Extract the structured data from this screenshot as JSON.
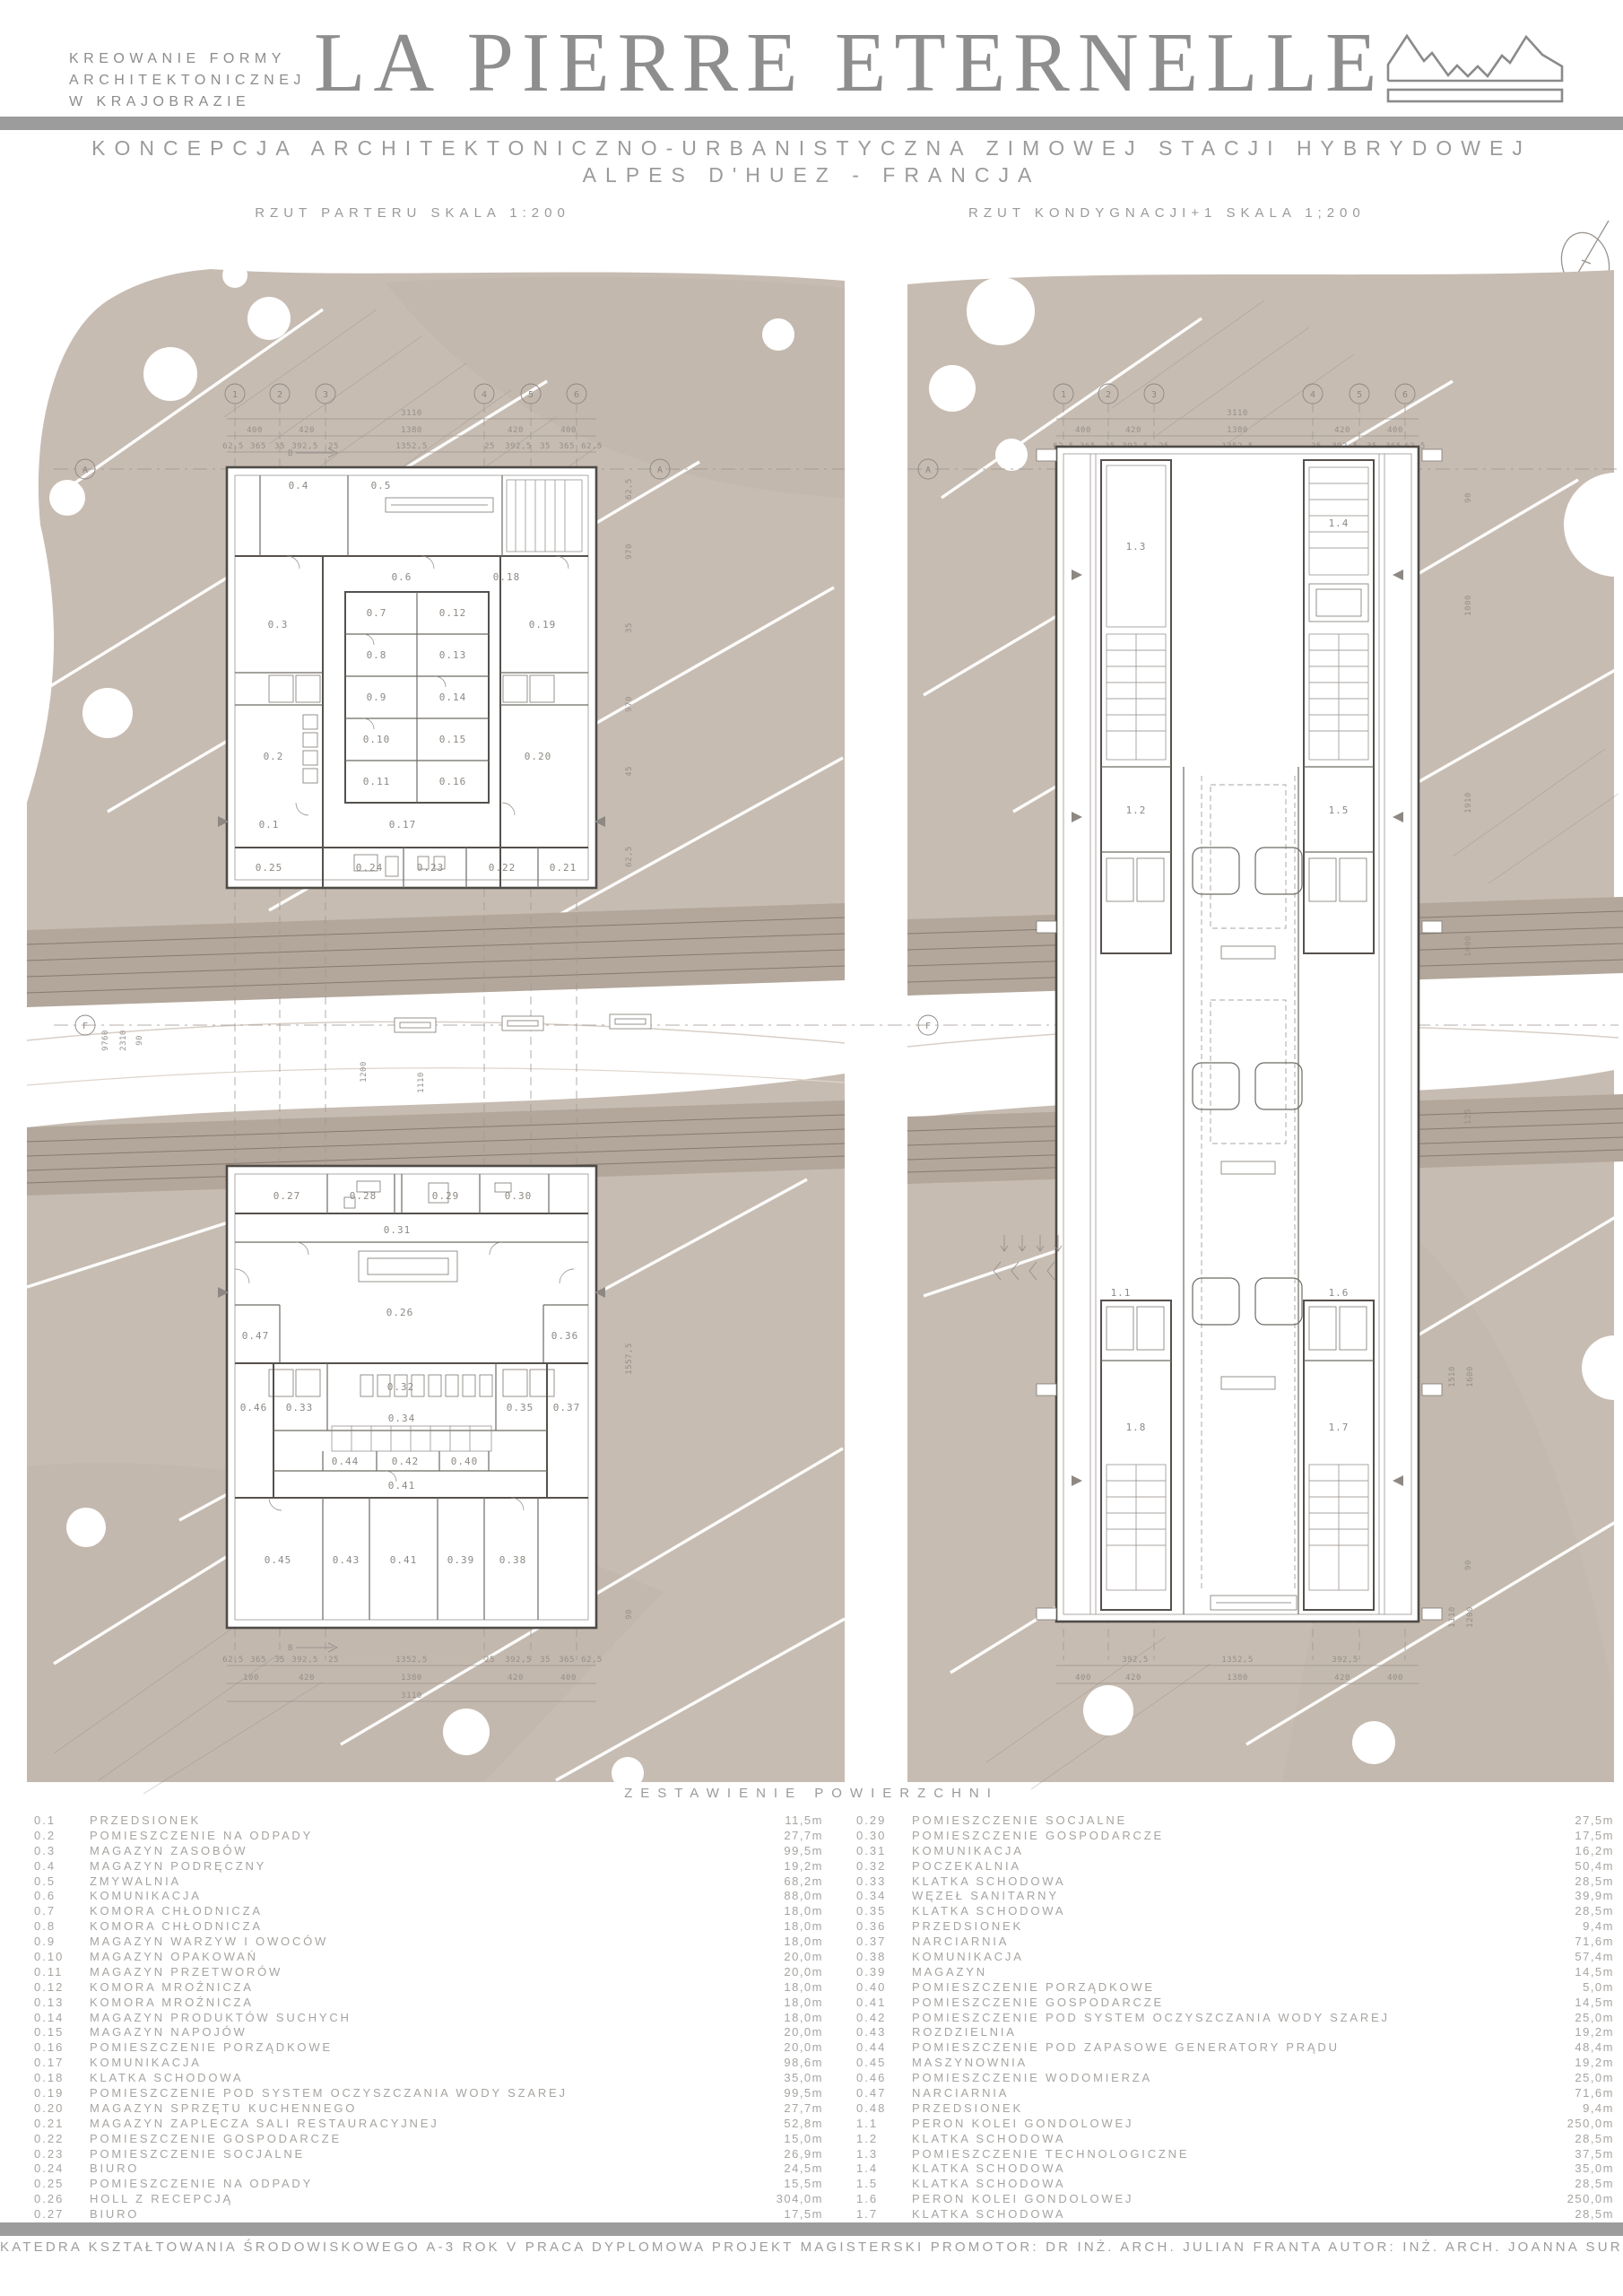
{
  "header": {
    "tagline_lines": [
      "KREOWANIE FORMY",
      "ARCHITEKTONICZNEJ",
      "W KRAJOBRAZIE"
    ],
    "title": "LA PIERRE ETERNELLE",
    "subtitle_line1": "KONCEPCJA ARCHITEKTONICZNO-URBANISTYCZNA ZIMOWEJ STACJI HYBRYDOWEJ",
    "subtitle_line2": "ALPES D'HUEZ - FRANCJA",
    "logo_icon": "mountain-ridge-logo",
    "accent_gray": "#9c9c9c"
  },
  "plans": {
    "left_label": "RZUT PARTERU SKALA 1:200",
    "right_label": "RZUT KONDYGNACJI+1 SKALA 1;200",
    "north_arrow_icon": "north-arrow"
  },
  "grid": {
    "b1": "1",
    "b2": "2",
    "b3": "3",
    "b4": "4",
    "b5": "5",
    "b6": "6",
    "bA": "A",
    "bF": "F",
    "section": "B"
  },
  "dims": {
    "d3110": "3110",
    "d400": "400",
    "d420": "420",
    "d1380": "1380",
    "d100": "100",
    "d625": "62,5",
    "d365": "365",
    "d35": "35",
    "d3925": "392,5",
    "d25": "25",
    "d13525": "1352,5",
    "d970": "970",
    "d45": "45",
    "d15575": "1557,5",
    "d90": "90",
    "d1000": "1000",
    "d1910": "1910",
    "d1600": "1600",
    "d1510": "1510",
    "d1110": "1110",
    "d1200": "1200",
    "d2310": "2310",
    "d9760": "9760",
    "d125": "125"
  },
  "rooms": {
    "r0_1": "0.1",
    "r0_2": "0.2",
    "r0_3": "0.3",
    "r0_4": "0.4",
    "r0_5": "0.5",
    "r0_6": "0.6",
    "r0_7": "0.7",
    "r0_8": "0.8",
    "r0_9": "0.9",
    "r0_10": "0.10",
    "r0_11": "0.11",
    "r0_12": "0.12",
    "r0_13": "0.13",
    "r0_14": "0.14",
    "r0_15": "0.15",
    "r0_16": "0.16",
    "r0_17": "0.17",
    "r0_18": "0.18",
    "r0_19": "0.19",
    "r0_20": "0.20",
    "r0_21": "0.21",
    "r0_22": "0.22",
    "r0_23": "0.23",
    "r0_24": "0.24",
    "r0_25": "0.25",
    "r0_26": "0.26",
    "r0_27": "0.27",
    "r0_28": "0.28",
    "r0_29": "0.29",
    "r0_30": "0.30",
    "r0_31": "0.31",
    "r0_32": "0.32",
    "r0_33": "0.33",
    "r0_34": "0.34",
    "r0_35": "0.35",
    "r0_36": "0.36",
    "r0_37": "0.37",
    "r0_38": "0.38",
    "r0_39": "0.39",
    "r0_40": "0.40",
    "r0_41": "0.41",
    "r0_42": "0.42",
    "r0_43": "0.43",
    "r0_44": "0.44",
    "r0_45": "0.45",
    "r0_46": "0.46",
    "r0_47": "0.47",
    "r1_1": "1.1",
    "r1_2": "1.2",
    "r1_3": "1.3",
    "r1_4": "1.4",
    "r1_5": "1.5",
    "r1_6": "1.6",
    "r1_7": "1.7",
    "r1_8": "1.8"
  },
  "areas": {
    "heading": "ZESTAWIENIE POWIERZCHNI",
    "left": [
      {
        "no": "0.1",
        "name": "PRZEDSIONEK",
        "area": "11,5m"
      },
      {
        "no": "0.2",
        "name": "POMIESZCZENIE NA ODPADY",
        "area": "27,7m"
      },
      {
        "no": "0.3",
        "name": "MAGAZYN ZASOBÓW",
        "area": "99,5m"
      },
      {
        "no": "0.4",
        "name": "MAGAZYN PODRĘCZNY",
        "area": "19,2m"
      },
      {
        "no": "0.5",
        "name": "ZMYWALNIA",
        "area": "68,2m"
      },
      {
        "no": "0.6",
        "name": "KOMUNIKACJA",
        "area": "88,0m"
      },
      {
        "no": "0.7",
        "name": "KOMORA CHŁODNICZA",
        "area": "18,0m"
      },
      {
        "no": "0.8",
        "name": "KOMORA CHŁODNICZA",
        "area": "18,0m"
      },
      {
        "no": "0.9",
        "name": "MAGAZYN WARZYW I OWOCÓW",
        "area": "18,0m"
      },
      {
        "no": "0.10",
        "name": "MAGAZYN OPAKOWAŃ",
        "area": "20,0m"
      },
      {
        "no": "0.11",
        "name": "MAGAZYN PRZETWORÓW",
        "area": "20,0m"
      },
      {
        "no": "0.12",
        "name": "KOMORA MROŹNICZA",
        "area": "18,0m"
      },
      {
        "no": "0.13",
        "name": "KOMORA MROŹNICZA",
        "area": "18,0m"
      },
      {
        "no": "0.14",
        "name": "MAGAZYN PRODUKTÓW SUCHYCH",
        "area": "18,0m"
      },
      {
        "no": "0.15",
        "name": "MAGAZYN NAPOJÓW",
        "area": "20,0m"
      },
      {
        "no": "0.16",
        "name": "POMIESZCZENIE PORZĄDKOWE",
        "area": "20,0m"
      },
      {
        "no": "0.17",
        "name": "KOMUNIKACJA",
        "area": "98,6m"
      },
      {
        "no": "0.18",
        "name": "KLATKA SCHODOWA",
        "area": "35,0m"
      },
      {
        "no": "0.19",
        "name": "POMIESZCZENIE POD SYSTEM OCZYSZCZANIA WODY SZAREJ",
        "area": "99,5m"
      },
      {
        "no": "0.20",
        "name": "MAGAZYN SPRZĘTU KUCHENNEGO",
        "area": "27,7m"
      },
      {
        "no": "0.21",
        "name": "MAGAZYN ZAPLECZA SALI RESTAURACYJNEJ",
        "area": "52,8m"
      },
      {
        "no": "0.22",
        "name": "POMIESZCZENIE GOSPODARCZE",
        "area": "15,0m"
      },
      {
        "no": "0.23",
        "name": "POMIESZCZENIE SOCJALNE",
        "area": "26,9m"
      },
      {
        "no": "0.24",
        "name": "BIURO",
        "area": "24,5m"
      },
      {
        "no": "0.25",
        "name": "POMIESZCZENIE NA ODPADY",
        "area": "15,5m"
      },
      {
        "no": "0.26",
        "name": "HOLL Z RECEPCJĄ",
        "area": "304,0m"
      },
      {
        "no": "0.27",
        "name": "BIURO",
        "area": "17,5m"
      },
      {
        "no": "0.28",
        "name": "BIURO",
        "area": "18,5m"
      }
    ],
    "right": [
      {
        "no": "0.29",
        "name": "POMIESZCZENIE SOCJALNE",
        "area": "27,5m"
      },
      {
        "no": "0.30",
        "name": "POMIESZCZENIE GOSPODARCZE",
        "area": "17,5m"
      },
      {
        "no": "0.31",
        "name": "KOMUNIKACJA",
        "area": "16,2m"
      },
      {
        "no": "0.32",
        "name": "POCZEKALNIA",
        "area": "50,4m"
      },
      {
        "no": "0.33",
        "name": "KLATKA SCHODOWA",
        "area": "28,5m"
      },
      {
        "no": "0.34",
        "name": "WĘZEŁ SANITARNY",
        "area": "39,9m"
      },
      {
        "no": "0.35",
        "name": "KLATKA SCHODOWA",
        "area": "28,5m"
      },
      {
        "no": "0.36",
        "name": "PRZEDSIONEK",
        "area": "9,4m"
      },
      {
        "no": "0.37",
        "name": "NARCIARNIA",
        "area": "71,6m"
      },
      {
        "no": "0.38",
        "name": "KOMUNIKACJA",
        "area": "57,4m"
      },
      {
        "no": "0.39",
        "name": "MAGAZYN",
        "area": "14,5m"
      },
      {
        "no": "0.40",
        "name": "POMIESZCZENIE PORZĄDKOWE",
        "area": "5,0m"
      },
      {
        "no": "0.41",
        "name": "POMIESZCZENIE GOSPODARCZE",
        "area": "14,5m"
      },
      {
        "no": "0.42",
        "name": "POMIESZCZENIE POD SYSTEM OCZYSZCZANIA WODY SZAREJ",
        "area": "25,0m"
      },
      {
        "no": "0.43",
        "name": "ROZDZIELNIA",
        "area": "19,2m"
      },
      {
        "no": "0.44",
        "name": "POMIESZCZENIE POD ZAPASOWE GENERATORY PRĄDU",
        "area": "48,4m"
      },
      {
        "no": "0.45",
        "name": "MASZYNOWNIA",
        "area": "19,2m"
      },
      {
        "no": "0.46",
        "name": "POMIESZCZENIE WODOMIERZA",
        "area": "25,0m"
      },
      {
        "no": "0.47",
        "name": "NARCIARNIA",
        "area": "71,6m"
      },
      {
        "no": "0.48",
        "name": "PRZEDSIONEK",
        "area": "9,4m"
      },
      {
        "no": "1.1",
        "name": "PERON KOLEI GONDOLOWEJ",
        "area": "250,0m"
      },
      {
        "no": "1.2",
        "name": "KLATKA SCHODOWA",
        "area": "28,5m"
      },
      {
        "no": "1.3",
        "name": "POMIESZCZENIE TECHNOLOGICZNE",
        "area": "37,5m"
      },
      {
        "no": "1.4",
        "name": "KLATKA SCHODOWA",
        "area": "35,0m"
      },
      {
        "no": "1.5",
        "name": "KLATKA SCHODOWA",
        "area": "28,5m"
      },
      {
        "no": "1.6",
        "name": "PERON KOLEI GONDOLOWEJ",
        "area": "250,0m"
      },
      {
        "no": "1.7",
        "name": "KLATKA SCHODOWA",
        "area": "28,5m"
      },
      {
        "no": "1.8",
        "name": "KLATKA SCHODOWA",
        "area": "28,5m"
      }
    ]
  },
  "footer": "KATEDRA KSZTAŁTOWANIA ŚRODOWISKOWEGO A-3 ROK V PRACA DYPLOMOWA PROJEKT MAGISTERSKI PROMOTOR: DR INŻ. ARCH. JULIAN FRANTA AUTOR: INŻ. ARCH. JOANNA SURUŁO"
}
